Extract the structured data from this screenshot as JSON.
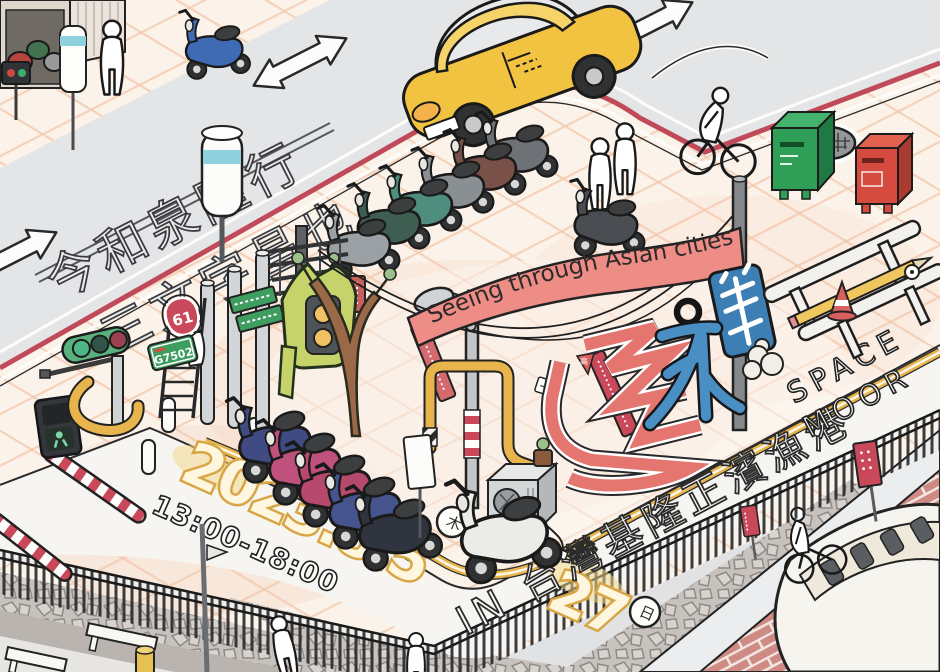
{
  "event": {
    "banner_title": "Seeing through Asian cities",
    "title_characters": "亞洲街角透視展"
  },
  "road": {
    "name_line1": "今和泉隆行",
    "name_line2": "三文字昌也"
  },
  "schedule": {
    "date_main": "2023.8.5",
    "start_day": "木",
    "arrow": "→",
    "date_end": "27",
    "end_day": "日",
    "time": "13:00-18:00"
  },
  "location": {
    "place": "IN 台灣基隆正濱漁港",
    "venue_line1": "SPACE",
    "venue_line2": "MOOR"
  },
  "signs": {
    "route_shield": "61",
    "expressway_plate": "G7502",
    "pennant_left": "高",
    "pennant_right": "壓"
  },
  "colors": {
    "accent_red": "#c0495a",
    "banner_pink": "#ee8c86",
    "title_red": "#e4766f",
    "title_blue": "#4a8fc4",
    "title_green": "#c5d36a",
    "date_gold": "#d8a544",
    "taxi_yellow": "#f2c340",
    "road_gray": "#e3e5e7",
    "plaza_cream": "#fbf3ea",
    "tile_line": "#f3c9ae"
  }
}
